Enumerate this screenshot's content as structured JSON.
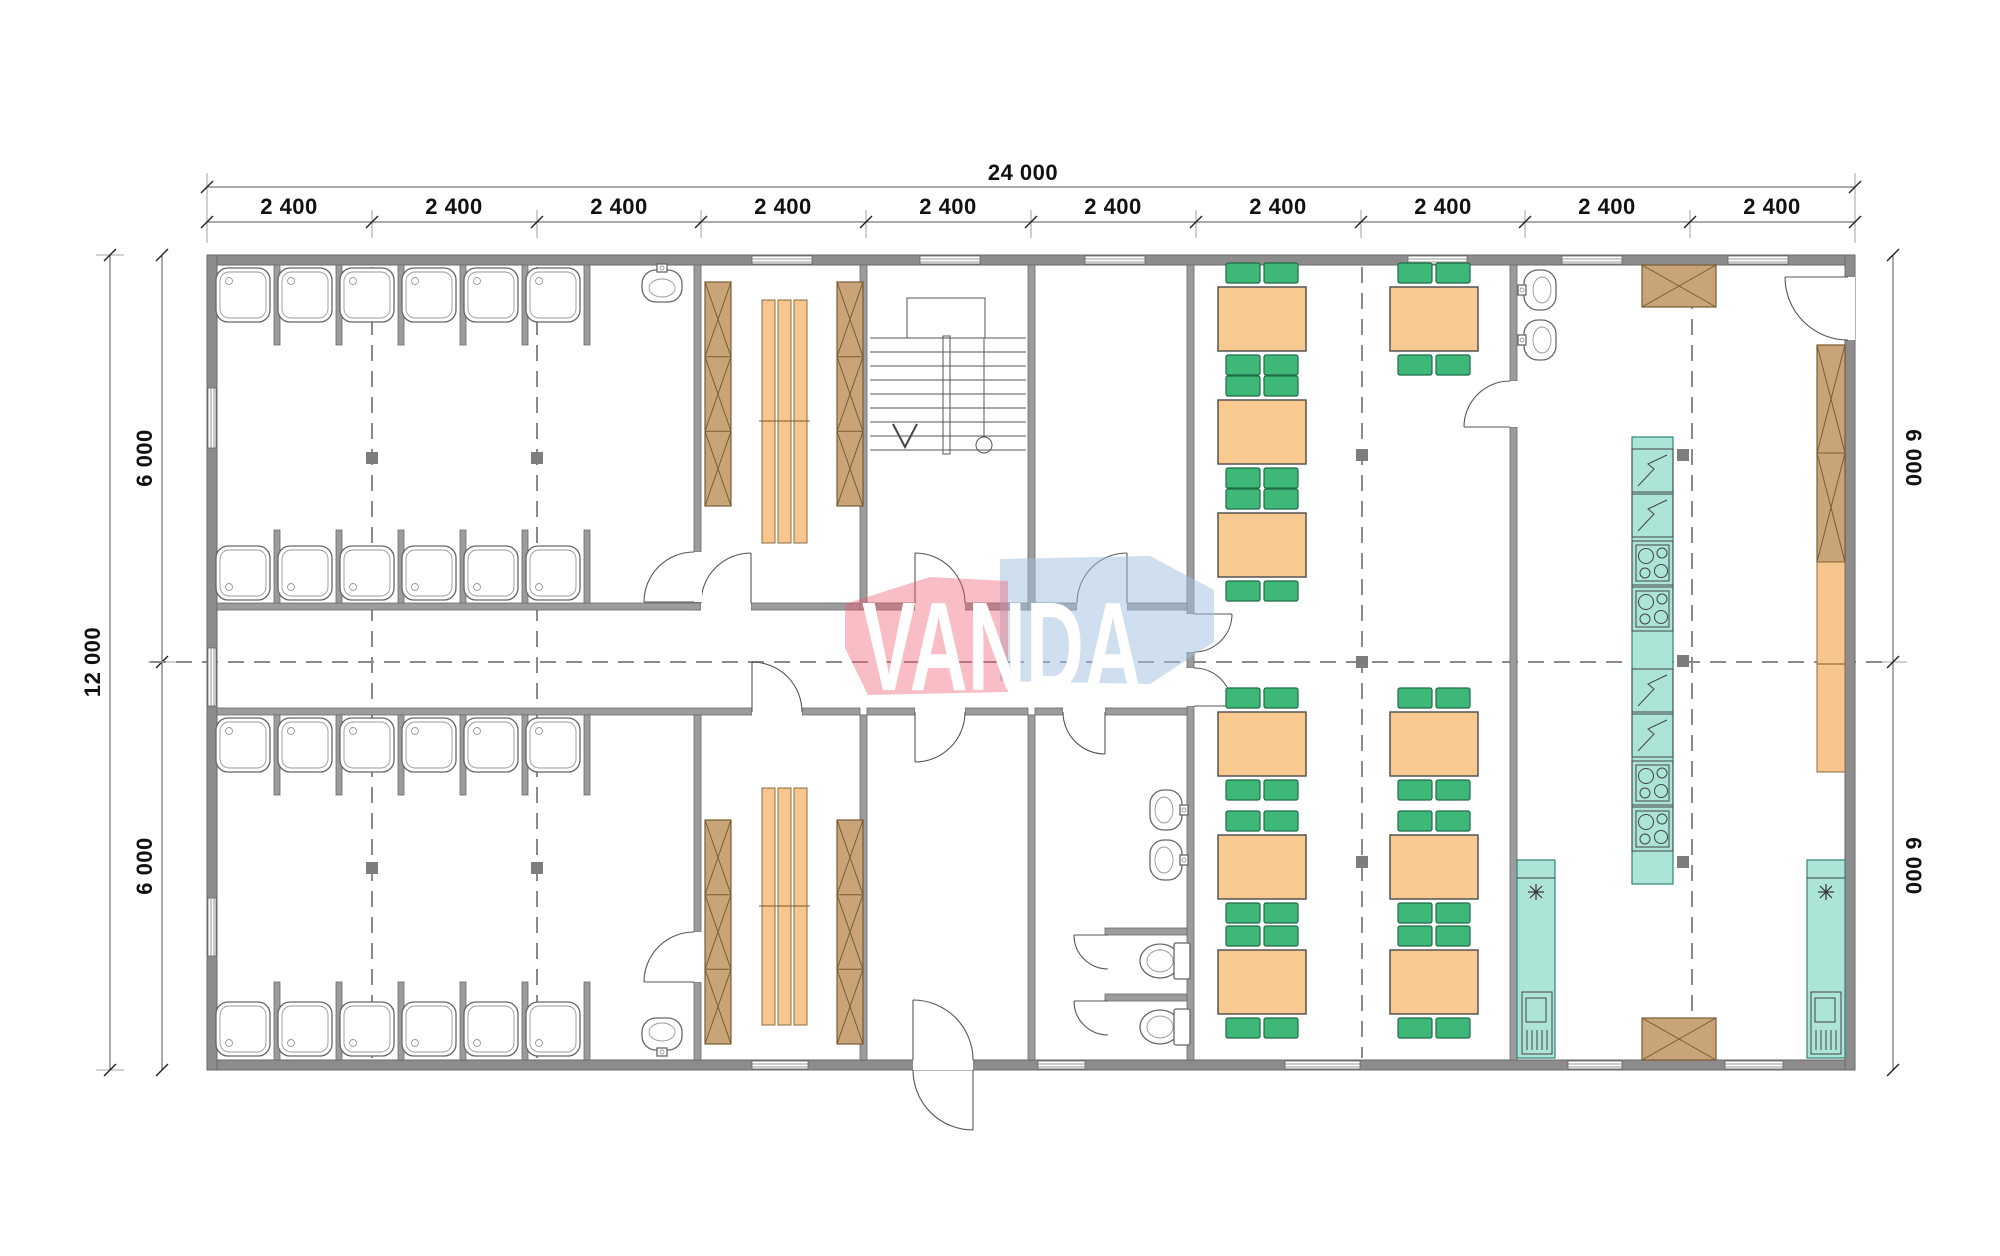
{
  "watermark": {
    "text": "VANDA",
    "pink_color": "#ef6b7b",
    "blue_color": "#a9c8e6"
  },
  "dimensions": {
    "total_width_label": "24 000",
    "segment_label": "2 400",
    "segment_count": 10,
    "total_height_label": "12 000",
    "half_height_label": "6 000"
  },
  "colors": {
    "wall_gray": "#8c8c8c",
    "wood_tan": "#c9a478",
    "bench_orange": "#f7c58e",
    "table_orange": "#f9c992",
    "chair_green": "#3eb878",
    "equipment_teal": "#ace4d8",
    "centerline_gray": "#8a8a8a"
  }
}
